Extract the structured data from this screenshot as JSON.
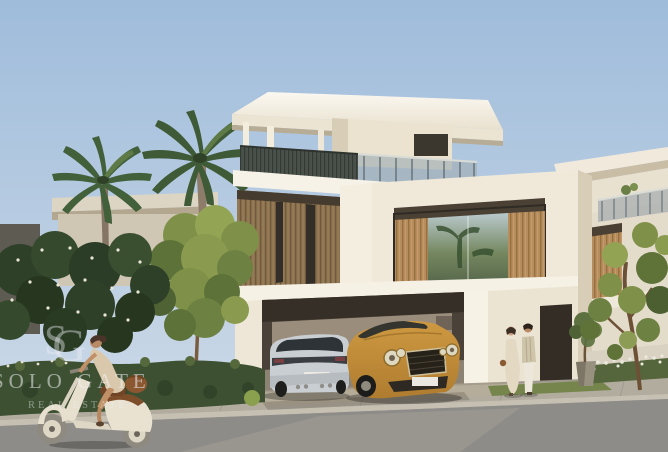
{
  "watermark": {
    "monogram": {
      "s": "S",
      "g": "G"
    },
    "brand": "SOLO GATE",
    "tagline": "REAL ESTATE"
  },
  "scene": {
    "description": "Architectural rendering of a modern cream villa with wood-slat facade and rooftop terrace; carport sheltering a silver SUV and a gold Bentley coupe; palm trees, green trees and hedges; a couple walking past the entrance; a woman riding a cream vintage scooter on the road in warm evening light.",
    "colors": {
      "sky_top": "#9fbcdb",
      "sky_horizon": "#ccd9e7",
      "villa_wall": "#f0e9da",
      "villa_wall_shaded": "#ddd2bd",
      "wood_cladding": "#8d7250",
      "wood_cladding_sunlit": "#b68d5f",
      "window_dark": "#37332b",
      "glass_green": "#6f8168",
      "hedge": "#3d5132",
      "tree_sunlit": "#8a9c50",
      "tree_dark": "#30452b",
      "palm_frond": "#42603a",
      "road": "#8e8c89",
      "sidewalk": "#b2ac9f",
      "driveway": "#a59b8c",
      "suv_silver": "#c9ced2",
      "bentley_gold": "#c08a38",
      "scooter_cream": "#e7e0cf",
      "watermark_text": "rgba(238,240,243,0.5)"
    }
  }
}
